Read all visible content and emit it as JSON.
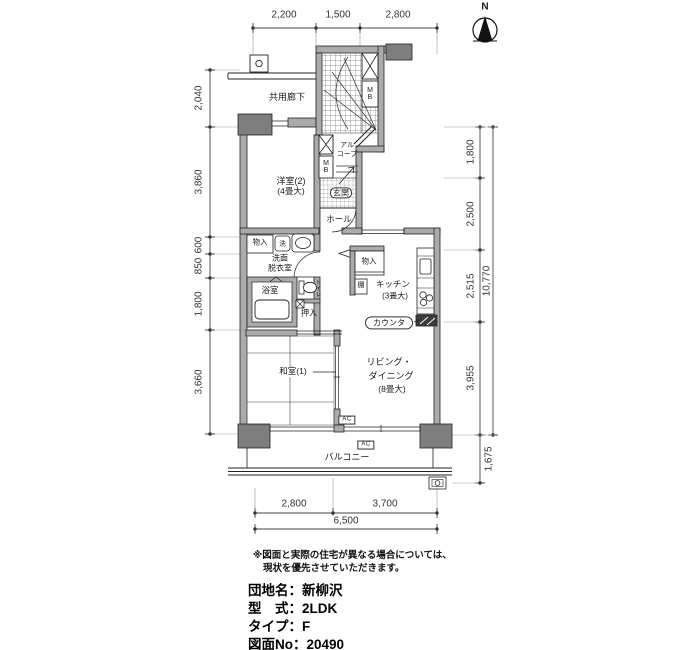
{
  "compass": {
    "north": "N"
  },
  "dimensions": {
    "top": [
      "2,200",
      "1,500",
      "2,800"
    ],
    "left": [
      "2,040",
      "3,860",
      "600",
      "850",
      "1,800",
      "3,660"
    ],
    "right": [
      "1,800",
      "2,500",
      "2,515",
      "3,955"
    ],
    "right_total": "10,770",
    "balcony_depth": "1,675",
    "bottom": [
      "2,800",
      "3,700"
    ],
    "bottom_total": "6,500"
  },
  "labels": {
    "corridor": "共用廊下",
    "western_room": {
      "l1": "洋室(2)",
      "l2": "(4畳大)"
    },
    "alcove": {
      "l1": "アル",
      "l2": "コーブ"
    },
    "meter_box": "MB",
    "entrance": "玄関",
    "hall": "ホール",
    "storage_left": "物入",
    "washer": "洗",
    "washroom": {
      "l1": "洗面",
      "l2": "脱衣室"
    },
    "bath": "浴室",
    "toilet": "トイレ",
    "closet": "押入",
    "storage_right": "物入",
    "shelf": "棚",
    "kitchen": {
      "l1": "キッチン",
      "l2": "(3畳大)"
    },
    "counter": "カウンタ",
    "living": {
      "l1": "リビング・",
      "l2": "ダイニング",
      "l3": "(8畳大)"
    },
    "japanese_room": "和室(1)",
    "balcony": "バルコニー",
    "ac": "AC"
  },
  "notes": {
    "line1": "※図面と実際の住宅が異なる場合については、",
    "line2": "現状を優先させていただきます。"
  },
  "info": {
    "estate": "団地名：新柳沢",
    "unit_type": "型　式：2LDK",
    "plan_type": "タイプ：F",
    "drawing_no": "図面No：20490"
  }
}
